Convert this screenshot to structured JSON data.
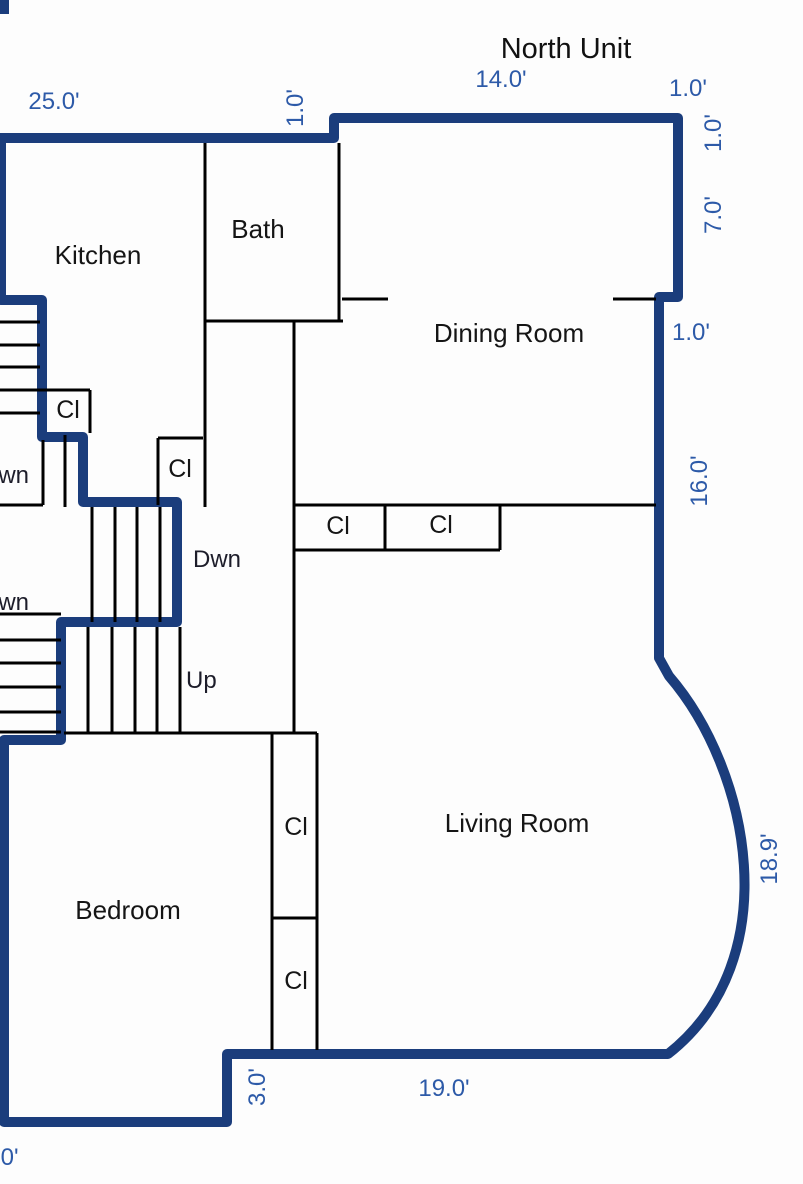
{
  "title": "North Unit",
  "colors": {
    "unit_wall": "#1b3d7c",
    "interior_wall": "#000000",
    "dimension_text": "#2d5aa8",
    "room_text": "#151515",
    "background": "#fdfdfd"
  },
  "rooms": {
    "kitchen": "Kitchen",
    "bath": "Bath",
    "dining": "Dining Room",
    "living": "Living Room",
    "bedroom": "Bedroom"
  },
  "closets": {
    "kitchen_cl": "Cl",
    "hall_cl": "Cl",
    "hall_closet_left": "Cl",
    "hall_closet_right": "Cl",
    "living_closet_upper": "Cl",
    "living_closet_lower": "Cl"
  },
  "stairs": {
    "upper_left_dwn": "Dwn",
    "center_dwn": "Dwn",
    "lower_left_dwn": "Dwn",
    "center_up": "Up"
  },
  "dimensions": {
    "top_left_width": "25.0'",
    "bath_step_width": "1.0'",
    "north_top_width": "14.0'",
    "north_right_width": "1.0'",
    "right_upper_depth": "1.0'",
    "right_dining_depth": "7.0'",
    "right_jog_width": "1.0'",
    "right_wall_depth": "16.0'",
    "curved_wall_depth": "18.9'",
    "bottom_width": "19.0'",
    "bottom_step_depth": "3.0'",
    "bottom_left_partial": ".0'"
  }
}
